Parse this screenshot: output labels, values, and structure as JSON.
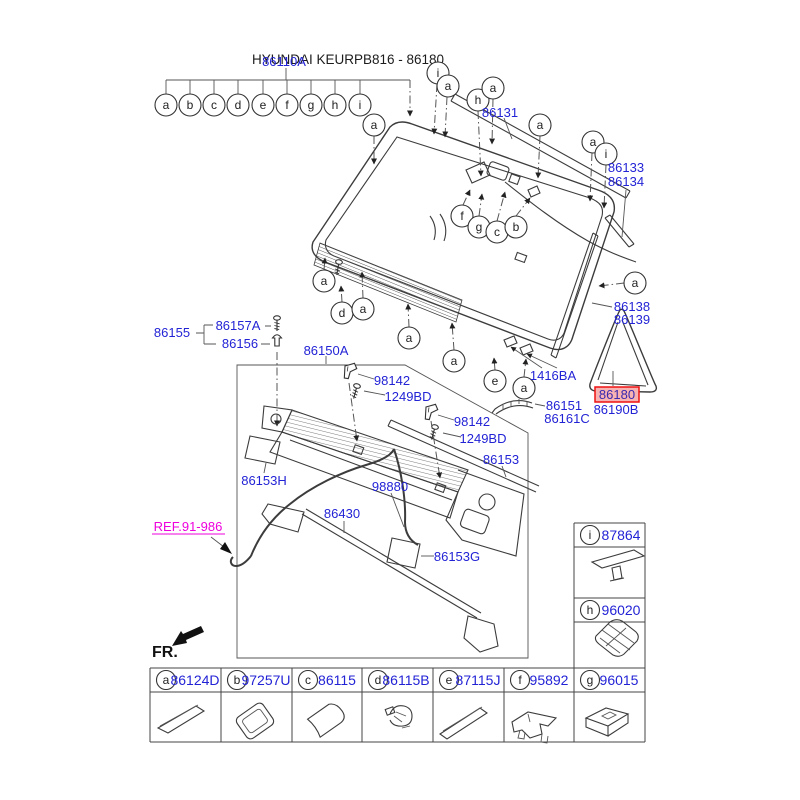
{
  "colors": {
    "label_blue": "#2323d6",
    "diagram_line": "#3c3c3c",
    "highlight_border": "#ee1111",
    "highlight_fill": "#f7b2b2",
    "ref_magenta": "#ee00dd"
  },
  "title": {
    "main": "HYUNDAI KEURPB816 - 86180",
    "overlay_part": "86110A"
  },
  "fr_label": "FR.",
  "ref_label": "REF.91-986",
  "parts": {
    "p86131": "86131",
    "p86133": "86133",
    "p86134": "86134",
    "p86138": "86138",
    "p86139": "86139",
    "p1416BA": "1416BA",
    "p86180": "86180",
    "p86190B": "86190B",
    "p86151": "86151",
    "p86161C": "86161C",
    "p86155": "86155",
    "p86157A": "86157A",
    "p86156": "86156",
    "p86150A": "86150A",
    "p98142_1": "98142",
    "p1249BD_1": "1249BD",
    "p98142_2": "98142",
    "p1249BD_2": "1249BD",
    "p86153": "86153",
    "p86153H": "86153H",
    "p98880": "98880",
    "p86430": "86430",
    "p86153G": "86153G"
  },
  "callouts": {
    "row": [
      "a",
      "b",
      "c",
      "d",
      "e",
      "f",
      "g",
      "h",
      "i"
    ],
    "scatter": [
      "a",
      "i",
      "a",
      "h",
      "a",
      "a",
      "a",
      "i",
      "a",
      "a",
      "d",
      "a",
      "a",
      "a",
      "e",
      "a",
      "f",
      "g",
      "c",
      "b"
    ]
  },
  "legend_table": {
    "bottom_row": [
      {
        "letter": "a",
        "part": "86124D"
      },
      {
        "letter": "b",
        "part": "97257U"
      },
      {
        "letter": "c",
        "part": "86115"
      },
      {
        "letter": "d",
        "part": "86115B"
      },
      {
        "letter": "e",
        "part": "87115J"
      },
      {
        "letter": "f",
        "part": "95892"
      },
      {
        "letter": "g",
        "part": "96015"
      }
    ],
    "right_column": [
      {
        "letter": "i",
        "part": "87864"
      },
      {
        "letter": "h",
        "part": "96020"
      }
    ]
  }
}
